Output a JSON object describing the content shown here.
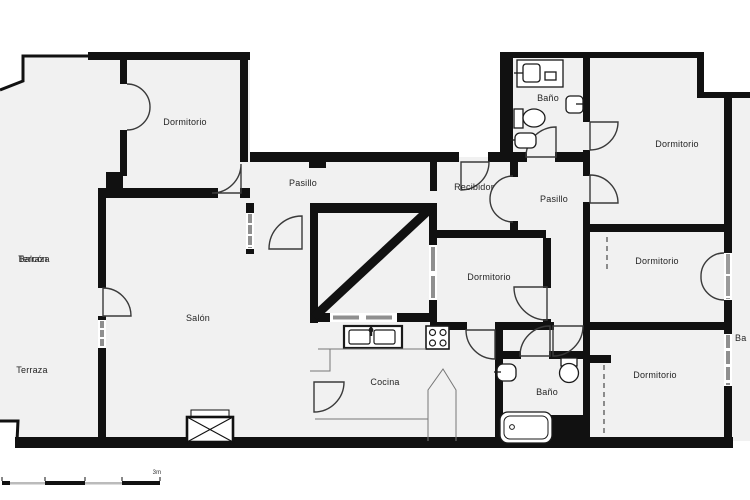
{
  "floor_plan": {
    "rooms": [
      {
        "id": "dormitorio-top-left",
        "label": "Dormitorio"
      },
      {
        "id": "pasillo-top",
        "label": "Pasillo"
      },
      {
        "id": "recibidor",
        "label": "Recibidor"
      },
      {
        "id": "bano-top",
        "label": "Baño"
      },
      {
        "id": "pasillo-right",
        "label": "Pasillo"
      },
      {
        "id": "dormitorio-top-right",
        "label": "Dormitorio"
      },
      {
        "id": "dormitorio-mid-right",
        "label": "Dormitorio"
      },
      {
        "id": "dormitorio-middle",
        "label": "Dormitorio"
      },
      {
        "id": "salon",
        "label": "Salón"
      },
      {
        "id": "terraza",
        "label": "Terraza"
      },
      {
        "id": "balcon-overprint",
        "label": "Balcón"
      },
      {
        "id": "terraza-overprint",
        "label": "Terraza"
      },
      {
        "id": "cocina",
        "label": "Cocina"
      },
      {
        "id": "bano-bottom",
        "label": "Baño"
      },
      {
        "id": "dormitorio-bottom-right",
        "label": "Dormitorio"
      },
      {
        "id": "balcon-right-clipped",
        "label": "Ba"
      }
    ],
    "scale_bar": {
      "label": "3m"
    },
    "colors": {
      "wall": "#111111",
      "floor": "#f1f1f1",
      "window": "#8f8f8f",
      "door_arc": "#3a3a3a",
      "label": "#252525",
      "background": "#ffffff"
    },
    "fixtures": [
      "vanity-counter",
      "vanity-sink",
      "soap-tray",
      "toilet",
      "bidet",
      "wall-basin",
      "kitchen-double-sink",
      "kitchen-faucet",
      "stove-4-burner",
      "counter-outline",
      "wall-sink",
      "toilet-bottom",
      "bathtub",
      "sliding-wardrobe-dashes",
      "crossed-box-furniture"
    ]
  }
}
